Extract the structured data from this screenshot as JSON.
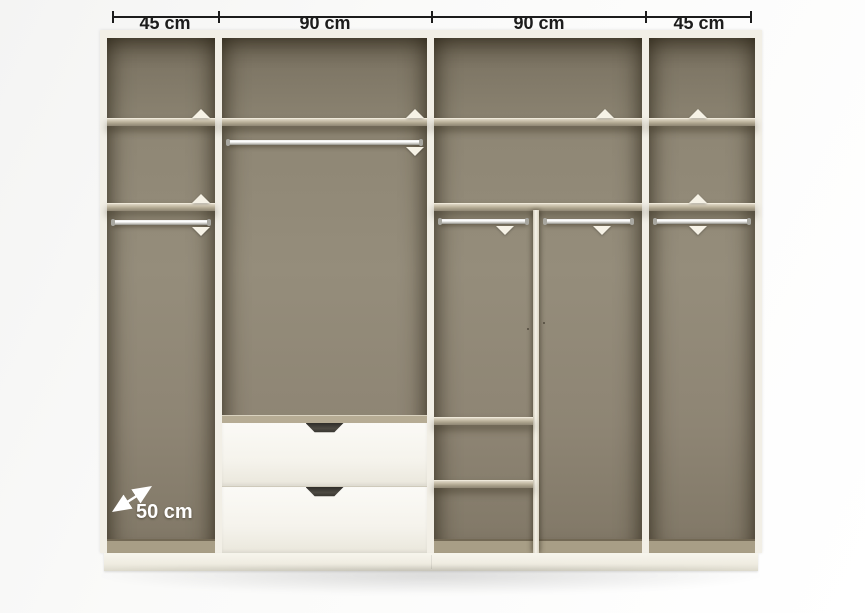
{
  "annotations": {
    "top_dimensions": [
      {
        "label": "45 cm"
      },
      {
        "label": "90 cm"
      },
      {
        "label": "90 cm"
      },
      {
        "label": "45 cm"
      }
    ],
    "depth": {
      "label": "50 cm"
    }
  },
  "wardrobe": {
    "total_width_label": "45 cm + 90 cm + 90 cm + 45 cm",
    "sections": [
      {
        "width_label": "45 cm",
        "features": [
          "shelf",
          "shelf",
          "hanging-rail"
        ]
      },
      {
        "width_label": "90 cm",
        "features": [
          "shelf",
          "hanging-rail",
          "drawer",
          "drawer"
        ]
      },
      {
        "width_label": "90 cm",
        "features": [
          "shelf",
          "shelf",
          "hanging-rail",
          "hanging-rail",
          "vertical-divider",
          "cubby-shelf",
          "cubby-shelf"
        ]
      },
      {
        "width_label": "45 cm",
        "features": [
          "shelf",
          "shelf",
          "hanging-rail"
        ]
      }
    ],
    "drawer_count": 2
  },
  "colors": {
    "frame": "#f2efe6",
    "interior": "#8d8473",
    "shelf": "#b3aa94",
    "drawer_front": "#f6f4ed",
    "handle": "#3c3a35",
    "rail": "#c9c8c2",
    "annotation_text": "#1c1c1c",
    "depth_text": "#ffffff",
    "background": "#fafafa"
  }
}
